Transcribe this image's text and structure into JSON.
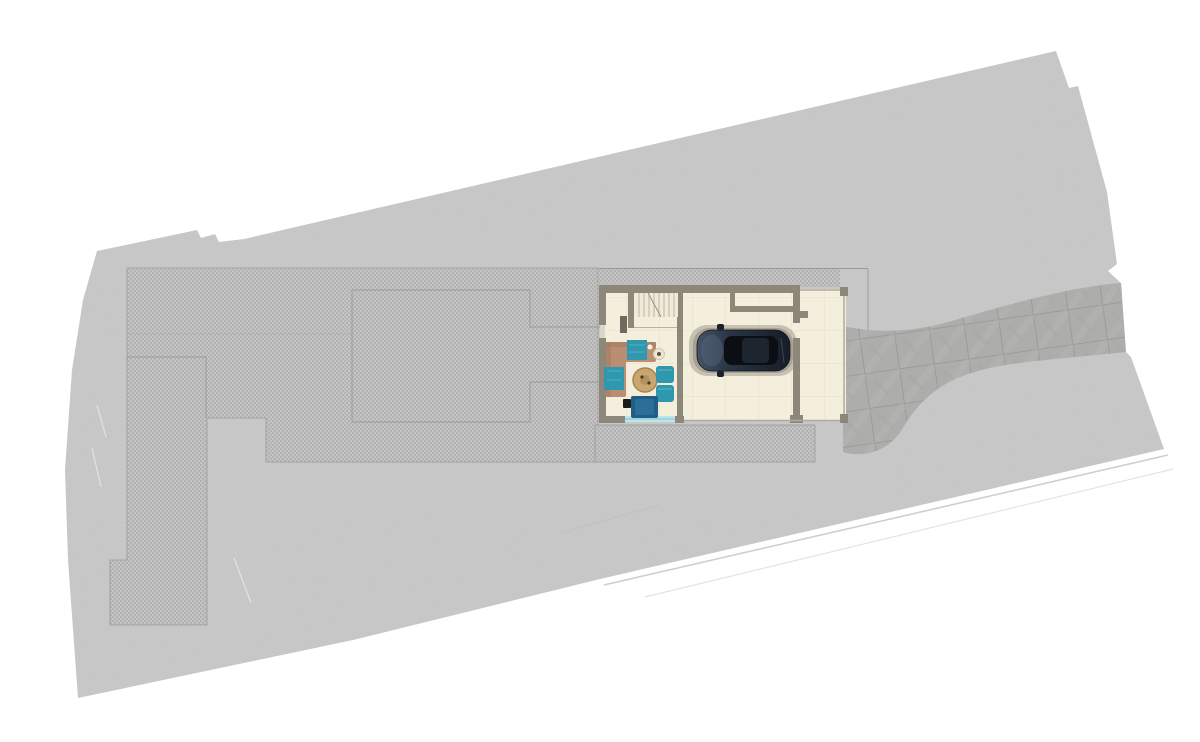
{
  "scene": {
    "type": "architectural-site-plan",
    "description": "Top-down site plan rendering of an elongated lot with ground-floor plan, parked car, terraces and paver driveway",
    "canvas": {
      "width": 1200,
      "height": 742
    }
  },
  "colors": {
    "background": "#ffffff",
    "lot": "#c9c9c9",
    "outline": "#9a9a94",
    "faint_line": "#aeaeae",
    "kerb_line_a": "#cfcfcf",
    "kerb_line_b": "#e4e4e4",
    "scratch": "#f2f2f2",
    "wall": "#8d8779",
    "wall_dark": "#6f6a5e",
    "porch_edge": "#b0aa9b",
    "window_gap": "#dcd6c8",
    "glass_door": "#bfe3ea",
    "glass_door_line": "#7fc4d4",
    "stair_tread": "#b9b29f",
    "stair_break": "#9a9383",
    "sofa": "#b98e71",
    "sofa_shade": "#a67c62",
    "teal": "#2f97ae",
    "teal_light": "#58b7c9",
    "navy_rug": "#205e86",
    "navy_rug_inner": "#2b6f97",
    "black_item": "#1b1b1b",
    "table_wood": "#c9a572",
    "table_wood_ring": "#a8854f",
    "table_wood_inner": "#b5915c",
    "side_table": "#ece6d6",
    "car_shadow": "#8f8a7b",
    "car_glass": "#0b0e13",
    "car_roof": "#1d2531",
    "car_mirror": "#1a212c",
    "car_outline": "#11161f",
    "hood_highlight": "#5b6b82"
  },
  "regions": {
    "lot": "property lot",
    "fine_paver_terrace": "fine paver terrace (left field, column and lower block)",
    "strip_above_house": "fine paver strip above house",
    "patio_strip": "fine paver patio below house",
    "terrace_outline": "outlined terrace rectangle with walkway to house",
    "driveway": "large paver driveway band",
    "house": "ground floor plan",
    "living_room": "living room",
    "staircase": "staircase",
    "garage": "open garage / car pad",
    "porch": "covered porch edge with posts",
    "car": "dark sedan parked in garage",
    "corner_sofa": "tan corner sofa with teal throws",
    "coffee_table": "round wooden coffee table",
    "side_table": "small round side table",
    "poufs": "two teal poufs",
    "lounge_rug": "navy lounge mat with black item",
    "kerb_lines": "road kerb lines lower right",
    "scratches": "faint surface scratch lines"
  }
}
